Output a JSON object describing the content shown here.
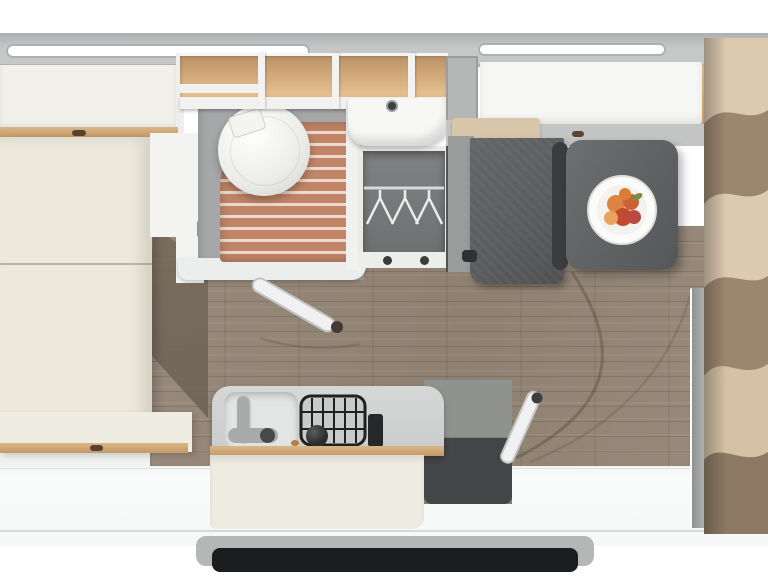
{
  "scene": {
    "type": "caravan-floorplan",
    "view": "top-down-3d-render",
    "visible_text": "none"
  },
  "colors": {
    "page-bg": "#ffffff",
    "wall": "#c6c8c8",
    "wall-edge": "#adafb0",
    "window-white": "#ffffff",
    "locker-cream": "#f2f0ea",
    "bed-cream": "#ece8db",
    "cabinet-cream": "#efece2",
    "wood-accent": "#d9b586",
    "shelf-wood": "#e2bd8d",
    "shelf-wood-dark": "#b98f62",
    "floor-wood": "#97897b",
    "floor-shadow": "#6e6255",
    "slat": "#c08466",
    "slat-gap": "#ecd9cc",
    "bath-gray": "#a6a7a8",
    "fixture-white": "#f7f8f6",
    "wardrobe-gray": "#7f8183",
    "bench-dark": "#595b5d",
    "bench-light": "#9a9c9c",
    "shelf-beige": "#d7c6a9",
    "table-gray": "#5f6163",
    "table-shadow": "#3a3c3e",
    "plate-white": "#fbfbf9",
    "fruit-orange": "#dd8442",
    "fruit-red": "#c24a2e",
    "leaf-green": "#7d8a42",
    "counter-gray": "#c9cbca",
    "sink-light": "#e3e5e4",
    "hob-dark": "#2b2d2e",
    "accent-red": "#8d2327",
    "partition-gray": "#b0b3b2",
    "fabric-light": "#dccab0",
    "fabric-mid": "#c2aa8c",
    "fabric-dark": "#9b8670",
    "rear-wood": "#d2ab7c",
    "step-frame": "#b5b7b7",
    "step-dark": "#1c1d1f",
    "door-white": "#f0f1f0"
  },
  "fixtures": [
    "double-bed",
    "overhead-locker",
    "window",
    "toilet",
    "shower",
    "washbasin",
    "wardrobe",
    "clothes-hangers",
    "fridge-cabinet",
    "dinette-bench",
    "dinette-table",
    "fruit-plate",
    "kitchen-sink",
    "gas-hob",
    "entrance-door",
    "bathroom-door",
    "partition-wall",
    "fabric-drape",
    "entry-step"
  ]
}
